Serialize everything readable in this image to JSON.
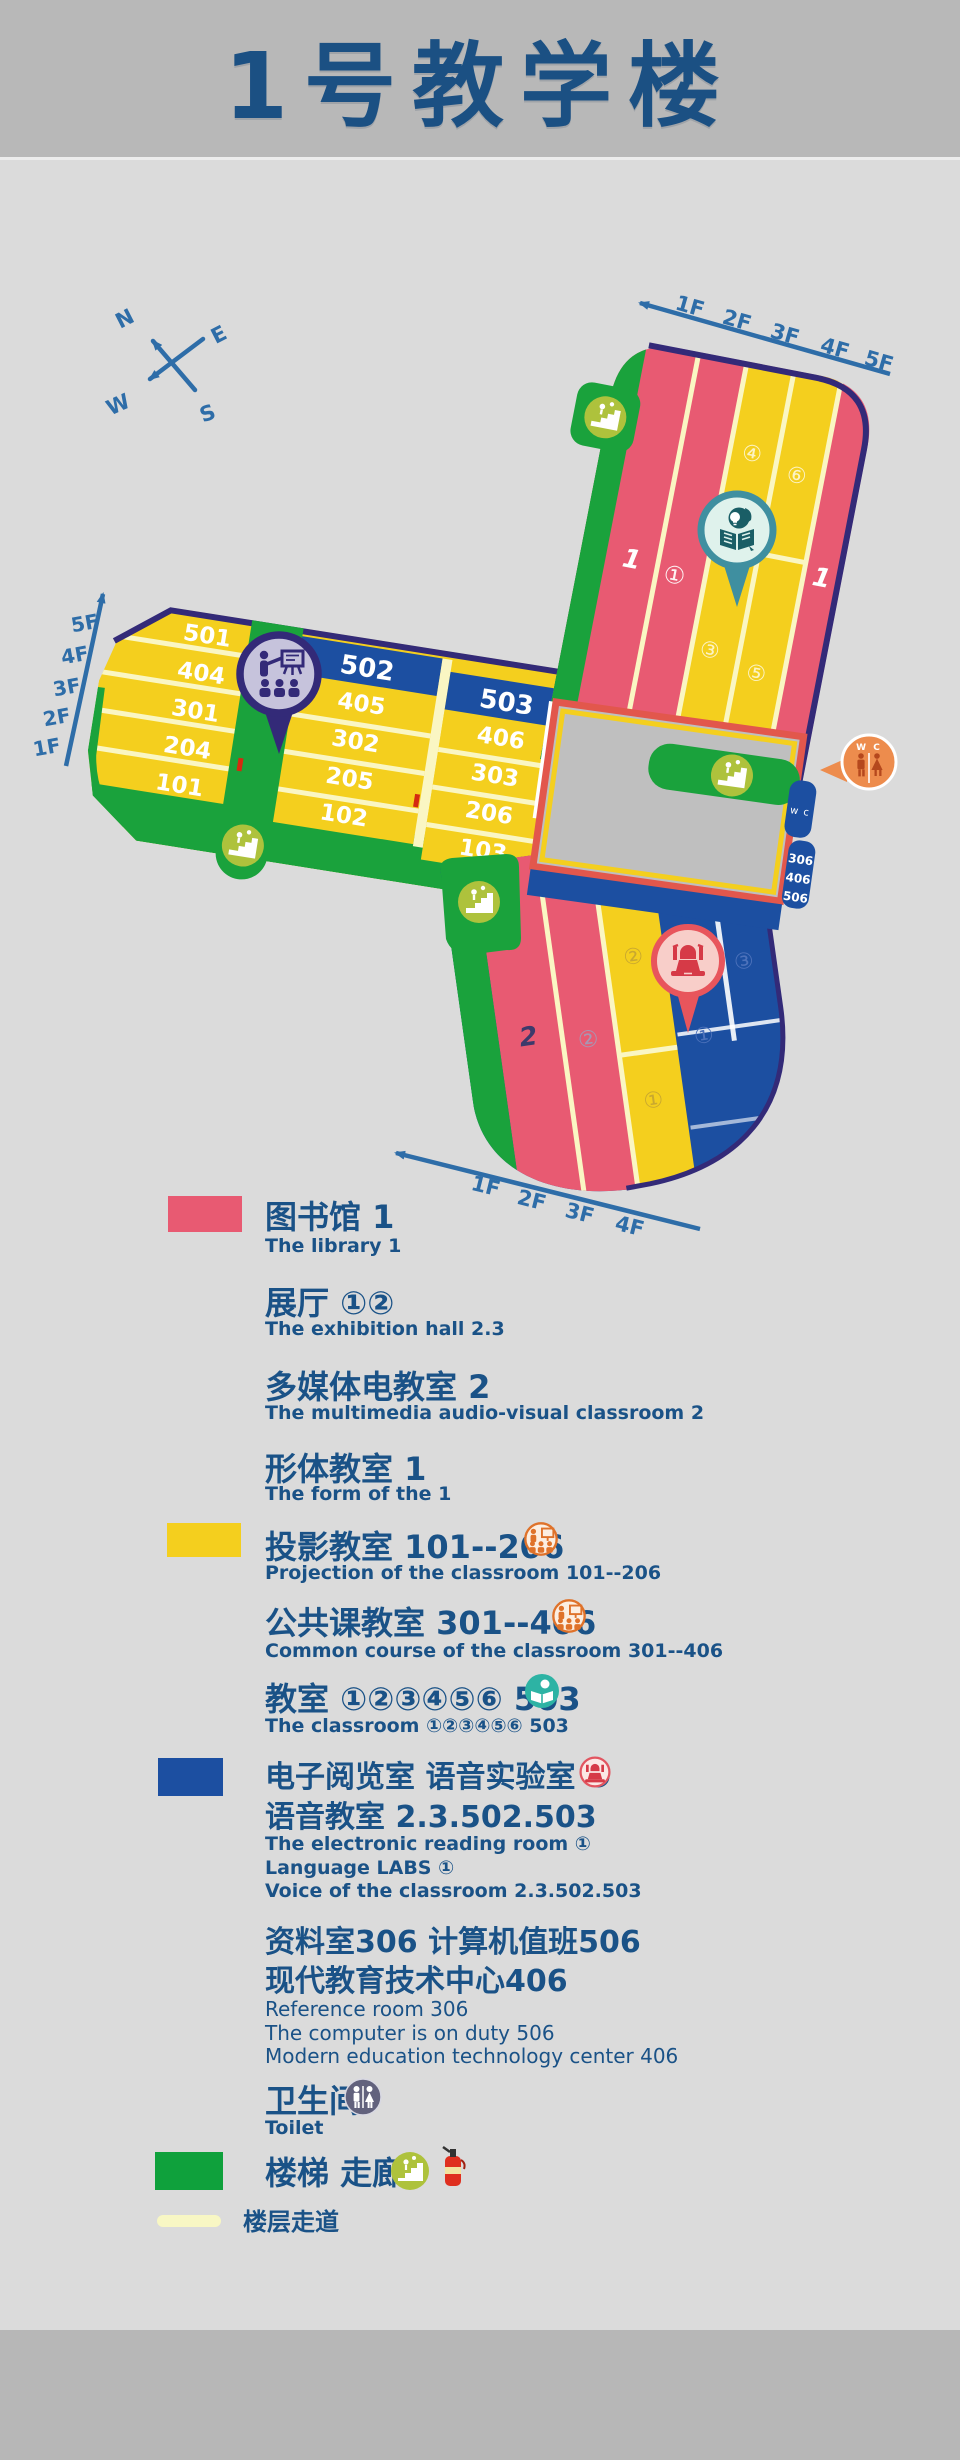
{
  "title": "1号教学楼",
  "compass": {
    "n": "N",
    "e": "E",
    "w": "W",
    "s": "S"
  },
  "map": {
    "arrows": {
      "ne": [
        "1F",
        "2F",
        "3F",
        "4F",
        "5F"
      ],
      "west": [
        "5F",
        "4F",
        "3F",
        "2F",
        "1F"
      ],
      "south": [
        "1F",
        "2F",
        "3F",
        "4F"
      ]
    },
    "west_arm": {
      "rows_a": [
        "501",
        "404",
        "301",
        "204",
        "101"
      ],
      "band_b": "502",
      "rows_b": [
        "405",
        "302",
        "205",
        "102"
      ],
      "band_c": "503",
      "rows_c": [
        "406",
        "303",
        "206",
        "103"
      ]
    },
    "ne_arm": {
      "pink_left": "1",
      "pink_mid": "①",
      "yellow_tl": "④",
      "yellow_tr": "⑥",
      "yellow_bl": "③",
      "yellow_br": "⑤",
      "pink_right": "1"
    },
    "south_arm": {
      "pink_left": "2",
      "pink_mid": "②",
      "yellow_top": "②",
      "yellow_bottom": "①",
      "blue_faint_a": "①",
      "blue_faint_b": "③"
    },
    "wc_small": "w c",
    "wc_pin": "W C",
    "room_block": [
      "306",
      "406",
      "506"
    ]
  },
  "legend": {
    "items": [
      {
        "title": "图书馆 1",
        "en": "The library 1"
      },
      {
        "title": "展厅 ①②",
        "en": "The exhibition hall 2.3"
      },
      {
        "title": "多媒体电教室 2",
        "en": "The multimedia audio-visual classroom 2"
      },
      {
        "title": "形体教室 1",
        "en": "The form of the  1"
      },
      {
        "title": "投影教室 101--206",
        "en": "Projection of the classroom 101--206"
      },
      {
        "title": "公共课教室 301--406",
        "en": "Common course of the classroom 301--406"
      },
      {
        "title": "教室 ①②③④⑤⑥ 503",
        "en": "The classroom ①②③④⑤⑥ 503"
      },
      {
        "title": "电子阅览室 语音实验室 ①",
        "title2": "语音教室 2.3.502.503",
        "en": "The electronic reading room ①",
        "en2": "Language LABS ①",
        "en3": "Voice of the classroom  2.3.502.503"
      },
      {
        "title": "资料室306 计算机值班506",
        "title2": "现代教育技术中心406",
        "en": "Reference room 306",
        "en2": "The computer is on duty 506",
        "en3": "Modern education technology center 406"
      },
      {
        "title": "卫生间",
        "en": "Toilet"
      },
      {
        "title": "楼梯 走廊"
      },
      {
        "title": "楼层走道"
      }
    ]
  },
  "colors": {
    "pink": "#E85A72",
    "yellow": "#F4CF1E",
    "blue": "#1C4FA1",
    "green": "#1AA23C",
    "olive": "#AEC23C",
    "purple": "#332A78",
    "lavender": "#C6C3DC",
    "teal": "#3F8FA0",
    "teal_pale": "#DFF2EC",
    "teal_dark": "#1A5E66",
    "red": "#E8555C",
    "red_glyph": "#D63A47",
    "red_pale": "#F8CEC9",
    "orange": "#ED8C4D",
    "orange_dark": "#B5481D",
    "courtyard": "#BFBFBF",
    "border_red": "#E2574C",
    "text_blue": "#1A5287",
    "arrow_blue": "#2E6DA8",
    "divider_pale": "#FAF6C3",
    "walkway_pale": "#F8F7C4",
    "header_gray": "#B8B8B8",
    "bg_gray": "#DBDBDB"
  }
}
